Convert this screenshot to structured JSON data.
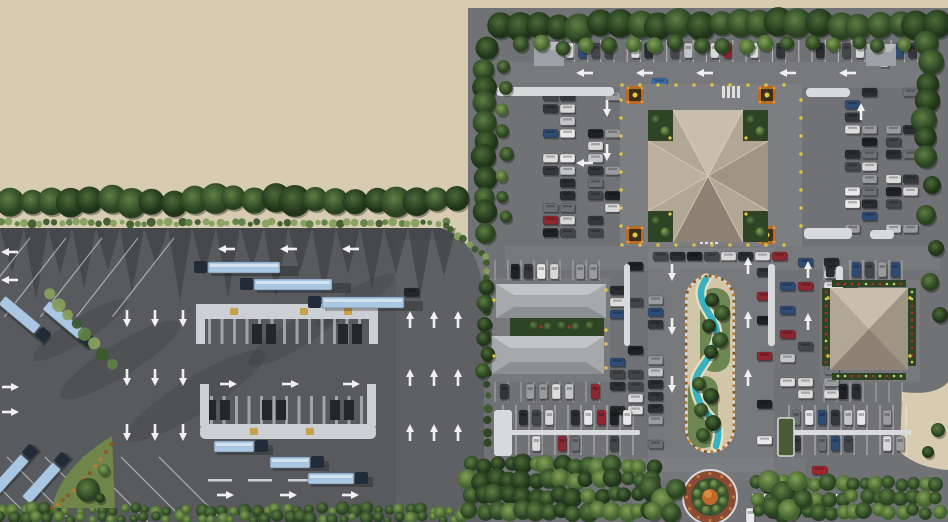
{
  "scene": {
    "title": "Aerial 3D rendering of a highway rest-area site plan with truck yard, fuel canopies, buildings, car parking, stream garden median and roundabout",
    "zones": {
      "sand": {
        "label": "vacant desert land"
      },
      "truck_yard": {
        "label": "truck parking and fuel station yard"
      },
      "main_complex": {
        "label": "rest-area complex with buildings and car parking"
      }
    },
    "features": {
      "main_building": "large square building with cross-gabled roof and corner gardens",
      "left_building": "twin grey-roof courtyard building",
      "right_building": "square pavilion with flower borders",
      "fuel_canopies": "two opposing truck fueling canopies",
      "median": "S-shaped stream garden island",
      "roundabout": "circular landscaped roundabout with orange centerpiece",
      "planters": "four ornamental orange planters at main plaza corners"
    }
  },
  "counts": {
    "boundary_trees": 23,
    "boundary_shrubs": 60,
    "top_border_trees": 23,
    "moving_trucks": 6,
    "parked_trucks": 5,
    "fuel_canopies": 2,
    "planters": 4,
    "roundabout_bushes": 8,
    "buildings": 3
  },
  "palette": {
    "sand": "#d7ccb1",
    "asphalt-dark": "#595a5e",
    "asphalt-light": "#717276",
    "marking": "#f0f0f0",
    "canopy": "#ccd0d4",
    "canopy-leg": "#a9adb1",
    "pump": "#24262a",
    "truck-trailer": "#a9c6e2",
    "truck-cab": "#222c38",
    "tree-dark": "#2c4423",
    "tree-mid": "#3c5a2d",
    "tree-light": "#5d7f44",
    "hedge": "#86a05e",
    "roof-light": "#c9beae",
    "roof-mid": "#b2a695",
    "roof-dark": "#a09484",
    "roof-deep": "#8e8274",
    "court-green": "#2f4425",
    "plaza": "#7d7e82",
    "island": "#d9dadc",
    "planter-orange": "#b76b24",
    "lamp-yellow": "#e8c83c",
    "flower-red": "#b03028",
    "water": "#38b2c0",
    "median-sand": "#d2c6a8",
    "median-border": "#b97a35",
    "rb-outer": "#8a4a33",
    "rb-ring": "#37512e",
    "rb-center": "#c06a2a",
    "car-colors": [
      "#e8e8e8",
      "#dcdcdc",
      "#c4c6c8",
      "#9a9c9e",
      "#2b2e31",
      "#1e2226",
      "#43474b",
      "#8f2732",
      "#2f4d74",
      "#6e7174",
      "#d8d8d8",
      "#33373b"
    ]
  }
}
